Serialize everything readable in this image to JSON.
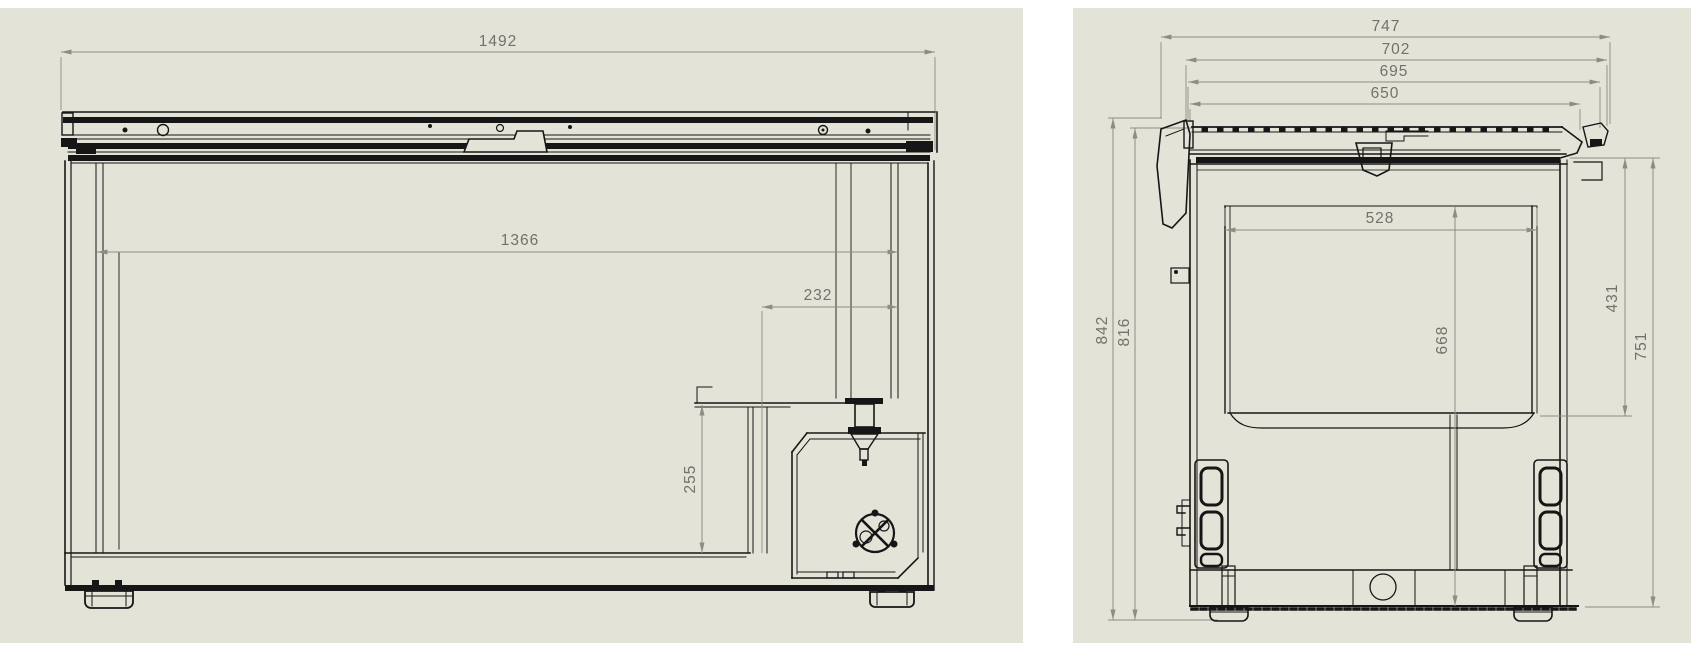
{
  "page": {
    "panel_background": "#e4e3d8",
    "line_color": "#161616",
    "dimension_color": "#8f8d82",
    "dimension_text_color": "#73716a"
  },
  "views": {
    "front": {
      "dims": {
        "overall_width": "1492",
        "inner_width": "1366",
        "recess_width": "232",
        "recess_height": "255"
      }
    },
    "side": {
      "dims": {
        "overall_depth": "747",
        "depth_to_handle": "702",
        "lid_outer_depth": "695",
        "lid_depth": "650",
        "inner_depth": "528",
        "inner_height": "668",
        "front_inner_height": "431",
        "front_height": "751",
        "overall_height": "842",
        "height_excl_feet": "816"
      }
    }
  }
}
